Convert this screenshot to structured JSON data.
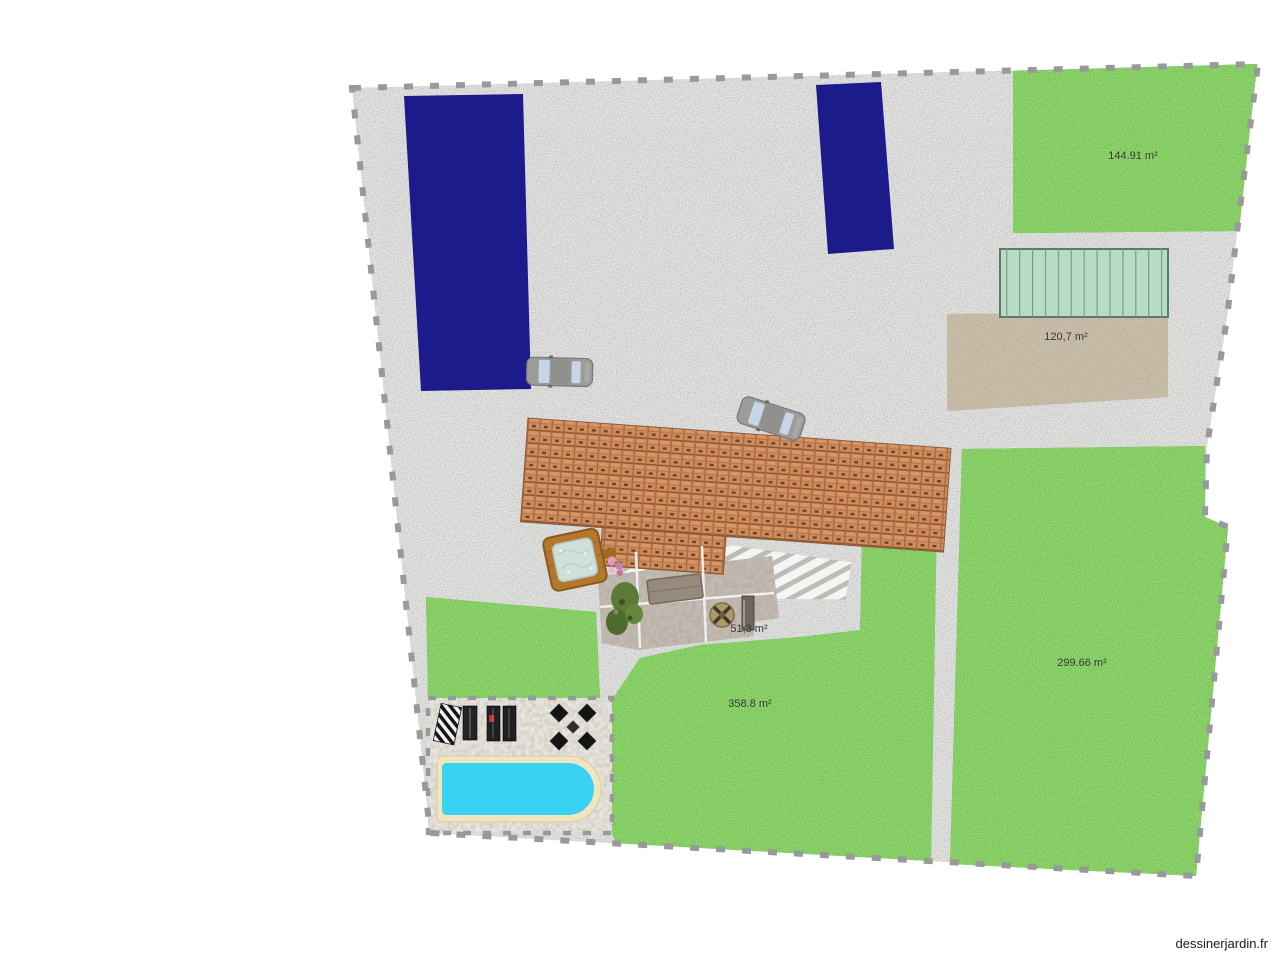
{
  "watermark": "dessinerjardin.fr",
  "labels": {
    "lawn_top_right": "144.91 m²",
    "terrace_brown": "120,7 m²",
    "patio": "51,3 m²",
    "lawn_middle": "358.8 m²",
    "lawn_right": "299.66 m²"
  },
  "colors": {
    "page_bg": "#ffffff",
    "gravel": "#d5d5d3",
    "grass": "#55ad2b",
    "pebble": "#d9d4ca",
    "sand": "#a59478",
    "navy": "#1b1b8c",
    "mint": "#b6dcc6",
    "roof": "#cf8d5e",
    "pool_water": "#3ad2f2",
    "pool_coping": "#f1e5c0",
    "patio_gray": "#a2968a",
    "car_body": "#9b9b99",
    "awning": "#f5f5f3",
    "border_dash": "#999999"
  }
}
